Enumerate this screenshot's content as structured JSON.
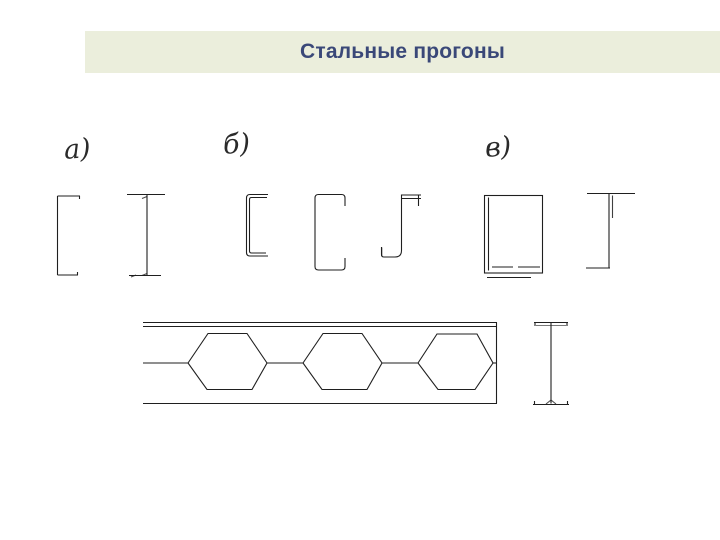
{
  "header": {
    "title": "Стальные прогоны",
    "background": "#ebeedc",
    "text_color": "#3a4878"
  },
  "figures": {
    "label_a": "а)",
    "label_b": "б)",
    "label_v": "в)"
  },
  "drawing": {
    "line_color": "#1f1f1f",
    "group_a_profiles": [
      "hot-rolled-channel-section",
      "i-beam-section"
    ],
    "group_b_profiles": [
      "cold-formed-channel-section",
      "lipped-channel-section",
      "zed-section"
    ],
    "group_v_profiles": [
      "welded-box-section",
      "asymmetric-i-section"
    ],
    "bottom_row": [
      "castellated-beam-elevation",
      "castellated-beam-i-cross-section"
    ],
    "castellated_openings_count": 3
  }
}
